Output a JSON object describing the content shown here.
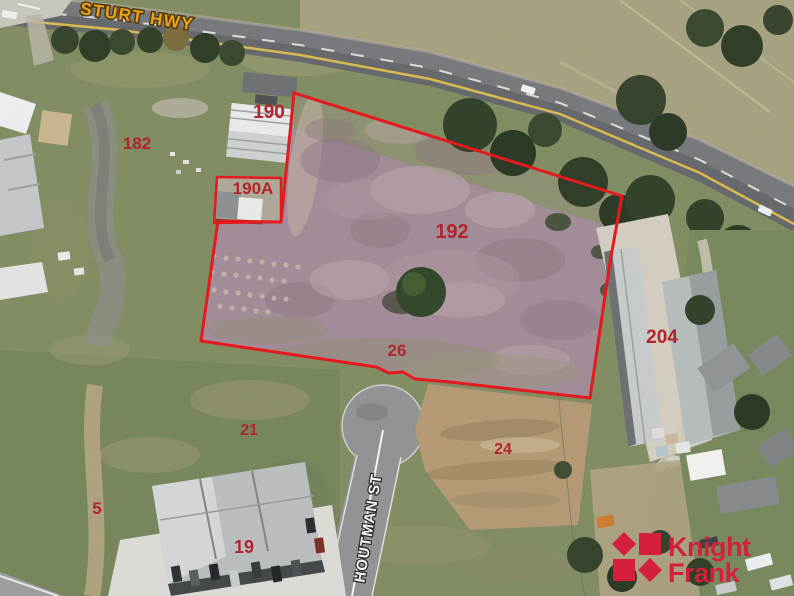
{
  "roads": {
    "sturt_hwy": "STURT HWY",
    "houtman_st": "HOUTMAN ST"
  },
  "lots": [
    {
      "id": "182",
      "label": "182"
    },
    {
      "id": "190",
      "label": "190"
    },
    {
      "id": "190A",
      "label": "190A"
    },
    {
      "id": "192",
      "label": "192"
    },
    {
      "id": "26",
      "label": "26"
    },
    {
      "id": "21",
      "label": "21"
    },
    {
      "id": "24",
      "label": "24"
    },
    {
      "id": "204",
      "label": "204"
    },
    {
      "id": "5",
      "label": "5"
    },
    {
      "id": "19",
      "label": "19"
    }
  ],
  "boundary": {
    "color": "#e6191e"
  },
  "labels": {
    "lot_color": "#b3242c",
    "sturt_color": "#f0a21e",
    "houtman_color": "#f5f5f5"
  },
  "logo": {
    "line1": "Knight",
    "line2": "Frank",
    "color": "#d4203c"
  }
}
